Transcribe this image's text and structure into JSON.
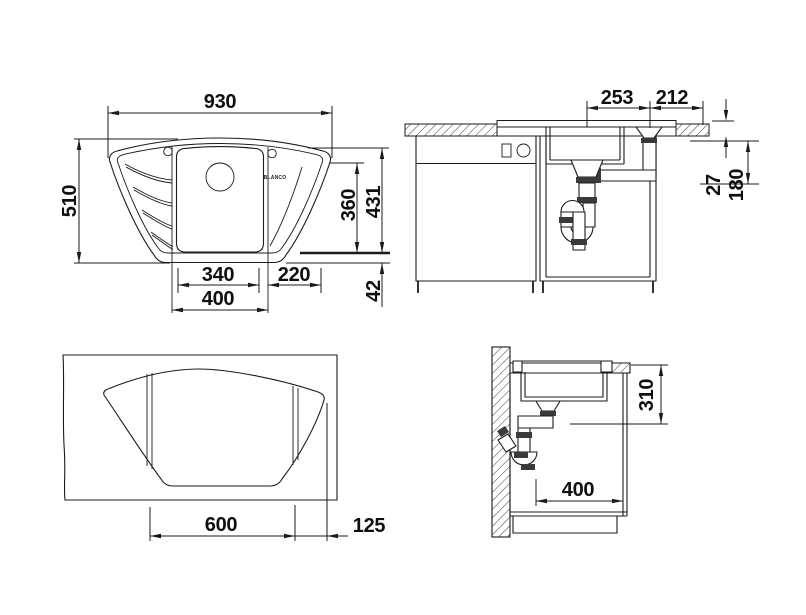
{
  "drawing": {
    "plan": {
      "width": "930",
      "depth": "510",
      "bowl_depth": "360",
      "depth_total": "431",
      "bowl_width": "340",
      "module_width": "400",
      "drainer_width": "220",
      "front_strip": "42",
      "logo": "BLANCO"
    },
    "front_section": {
      "span_left": "253",
      "span_right": "212",
      "rim_height": "27",
      "drain_depth": "180"
    },
    "cutout": {
      "width": "600",
      "corner_offset": "125"
    },
    "side_section": {
      "bowl_depth": "310",
      "clearance": "400"
    }
  }
}
